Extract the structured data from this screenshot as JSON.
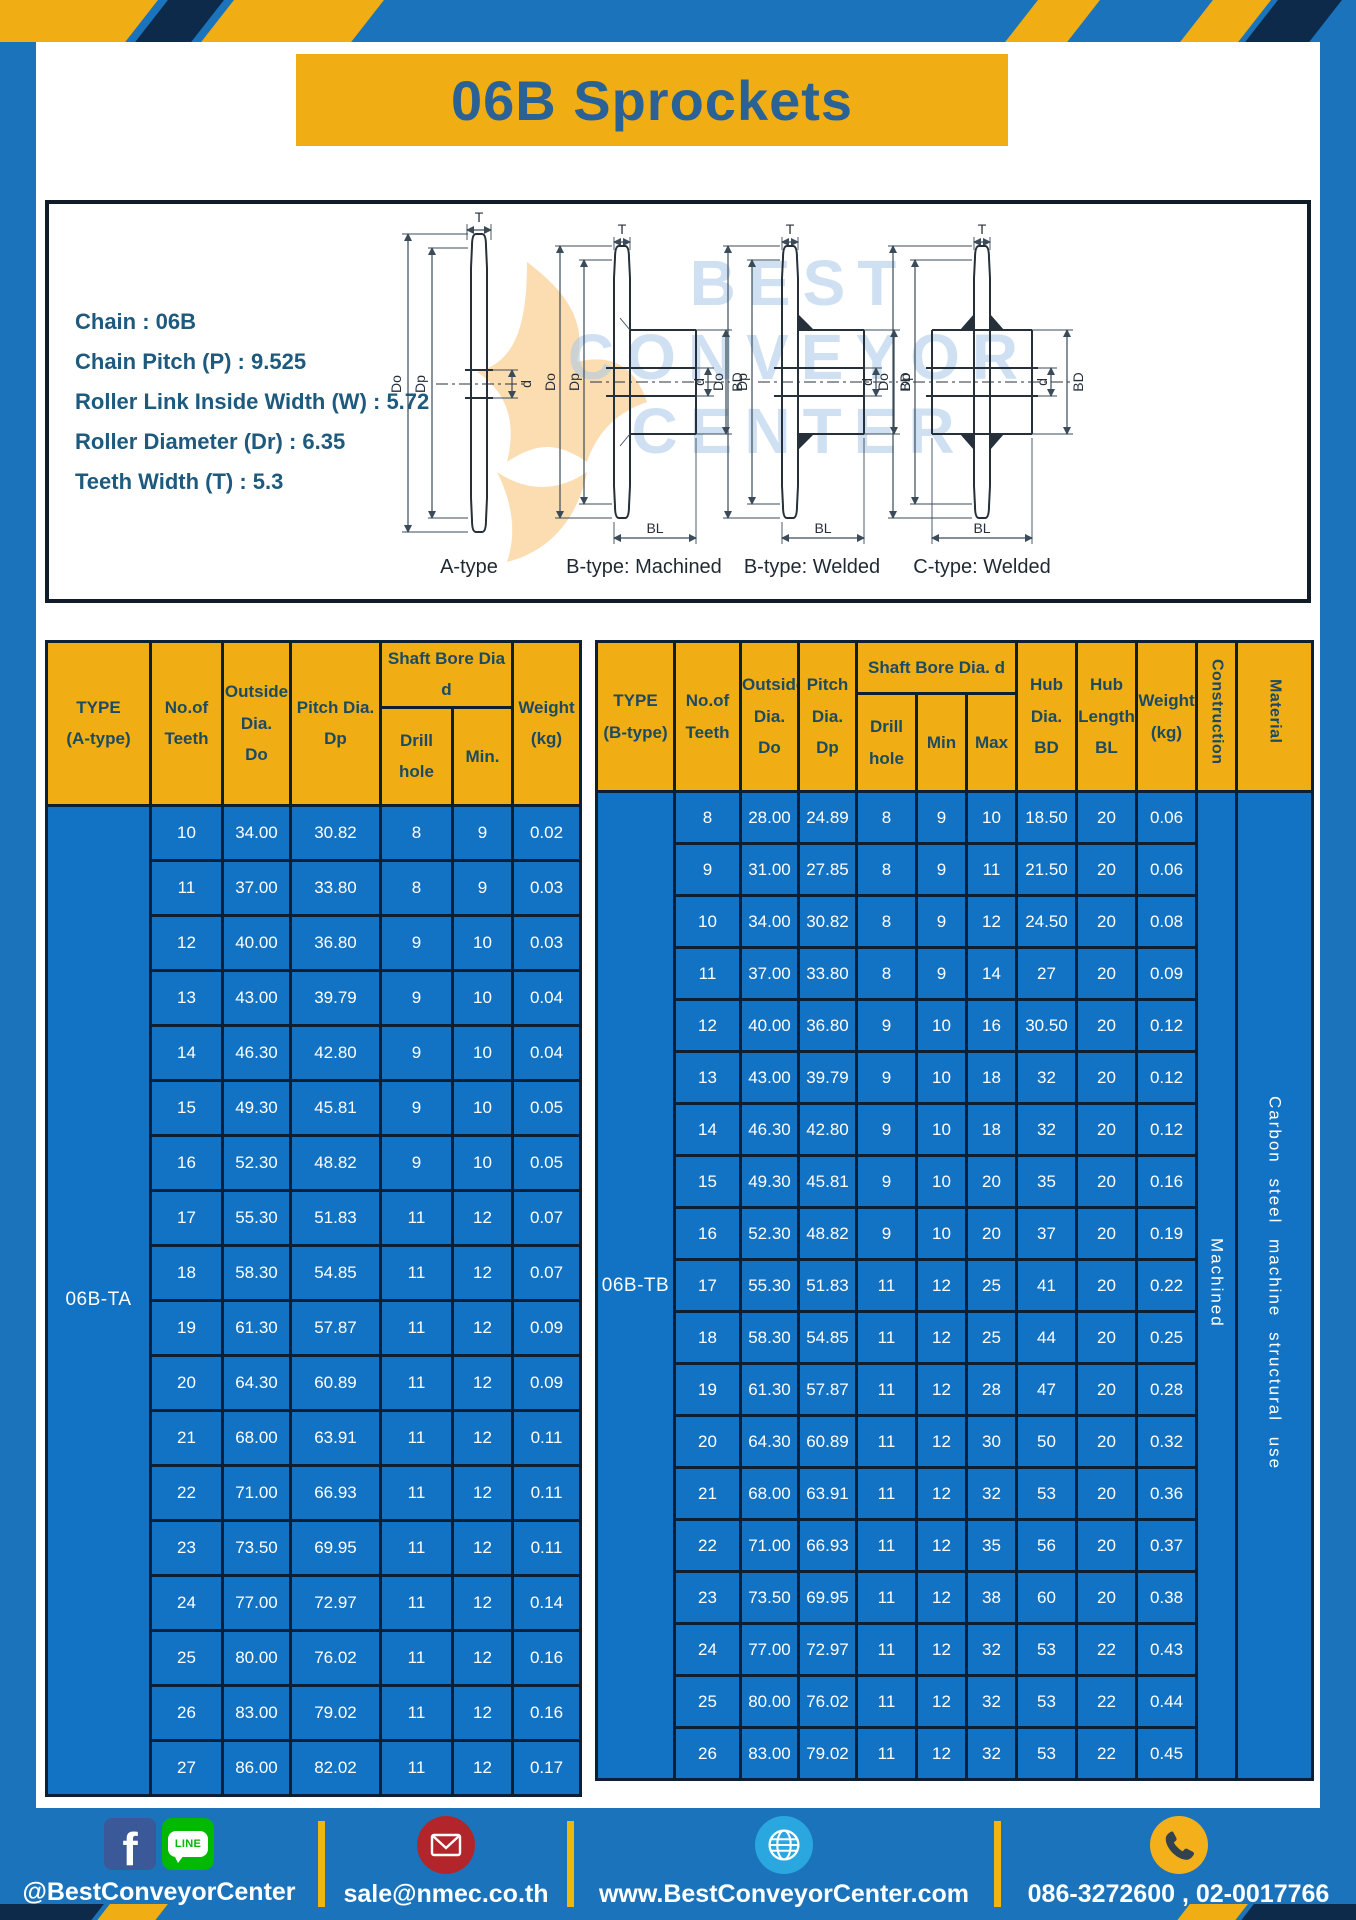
{
  "title": "06B Sprockets",
  "colors": {
    "page_blue": "#1B74BB",
    "cell_blue": "#1272C4",
    "header_yellow": "#F0AD14",
    "grid_dark": "#0D1F33",
    "title_blue": "#2B6295",
    "spec_teal": "#1D5A7E",
    "header_text": "#1C4B61",
    "stripe_navy": "#0D2A4A",
    "footer_divider": "#EFB70D"
  },
  "specs": {
    "chain": "Chain : 06B",
    "pitch": "Chain Pitch (P) : 9.525",
    "roller_width": "Roller Link Inside Width (W) : 5.72",
    "roller_dia": "Roller Diameter (Dr) : 6.35",
    "teeth_width": "Teeth Width (T) : 5.3"
  },
  "watermark": {
    "line1": "BEST",
    "line2": "CONVEYOR",
    "line3": "CENTER"
  },
  "drawings": {
    "labels": {
      "a": "A-type",
      "b_machined": "B-type: Machined",
      "b_welded": "B-type: Welded",
      "c_welded": "C-type: Welded"
    },
    "dims": {
      "t": "T",
      "do": "Do",
      "dp": "Dp",
      "d": "d",
      "bd": "BD",
      "bl": "BL"
    }
  },
  "table_a": {
    "type_label": "06B-TA",
    "header": {
      "type": "TYPE\n(A-type)",
      "teeth": "No.of\nTeeth",
      "outside": "Outside\nDia.\nDo",
      "pitch": "Pitch Dia.\nDp",
      "bore": "Shaft Bore Dia d",
      "drill": "Drill hole",
      "min": "Min.",
      "weight": "Weight\n(kg)"
    },
    "rows": [
      [
        "10",
        "34.00",
        "30.82",
        "8",
        "9",
        "0.02"
      ],
      [
        "11",
        "37.00",
        "33.80",
        "8",
        "9",
        "0.03"
      ],
      [
        "12",
        "40.00",
        "36.80",
        "9",
        "10",
        "0.03"
      ],
      [
        "13",
        "43.00",
        "39.79",
        "9",
        "10",
        "0.04"
      ],
      [
        "14",
        "46.30",
        "42.80",
        "9",
        "10",
        "0.04"
      ],
      [
        "15",
        "49.30",
        "45.81",
        "9",
        "10",
        "0.05"
      ],
      [
        "16",
        "52.30",
        "48.82",
        "9",
        "10",
        "0.05"
      ],
      [
        "17",
        "55.30",
        "51.83",
        "11",
        "12",
        "0.07"
      ],
      [
        "18",
        "58.30",
        "54.85",
        "11",
        "12",
        "0.07"
      ],
      [
        "19",
        "61.30",
        "57.87",
        "11",
        "12",
        "0.09"
      ],
      [
        "20",
        "64.30",
        "60.89",
        "11",
        "12",
        "0.09"
      ],
      [
        "21",
        "68.00",
        "63.91",
        "11",
        "12",
        "0.11"
      ],
      [
        "22",
        "71.00",
        "66.93",
        "11",
        "12",
        "0.11"
      ],
      [
        "23",
        "73.50",
        "69.95",
        "11",
        "12",
        "0.11"
      ],
      [
        "24",
        "77.00",
        "72.97",
        "11",
        "12",
        "0.14"
      ],
      [
        "25",
        "80.00",
        "76.02",
        "11",
        "12",
        "0.16"
      ],
      [
        "26",
        "83.00",
        "79.02",
        "11",
        "12",
        "0.16"
      ],
      [
        "27",
        "86.00",
        "82.02",
        "11",
        "12",
        "0.17"
      ]
    ]
  },
  "table_b": {
    "type_label": "06B-TB",
    "construction": "Machined",
    "material": "Carbon steel machine structural use",
    "header": {
      "type": "TYPE\n(B-type)",
      "teeth": "No.of\nTeeth",
      "outside": "Outside\nDia.\nDo",
      "pitch": "Pitch\nDia.\nDp",
      "bore": "Shaft Bore Dia. d",
      "drill": "Drill hole",
      "min": "Min",
      "max": "Max",
      "hub_dia": "Hub\nDia.\nBD",
      "hub_len": "Hub\nLength\nBL",
      "weight": "Weight\n(kg)",
      "construction": "Construction",
      "material": "Material"
    },
    "rows": [
      [
        "8",
        "28.00",
        "24.89",
        "8",
        "9",
        "10",
        "18.50",
        "20",
        "0.06"
      ],
      [
        "9",
        "31.00",
        "27.85",
        "8",
        "9",
        "11",
        "21.50",
        "20",
        "0.06"
      ],
      [
        "10",
        "34.00",
        "30.82",
        "8",
        "9",
        "12",
        "24.50",
        "20",
        "0.08"
      ],
      [
        "11",
        "37.00",
        "33.80",
        "8",
        "9",
        "14",
        "27",
        "20",
        "0.09"
      ],
      [
        "12",
        "40.00",
        "36.80",
        "9",
        "10",
        "16",
        "30.50",
        "20",
        "0.12"
      ],
      [
        "13",
        "43.00",
        "39.79",
        "9",
        "10",
        "18",
        "32",
        "20",
        "0.12"
      ],
      [
        "14",
        "46.30",
        "42.80",
        "9",
        "10",
        "18",
        "32",
        "20",
        "0.12"
      ],
      [
        "15",
        "49.30",
        "45.81",
        "9",
        "10",
        "20",
        "35",
        "20",
        "0.16"
      ],
      [
        "16",
        "52.30",
        "48.82",
        "9",
        "10",
        "20",
        "37",
        "20",
        "0.19"
      ],
      [
        "17",
        "55.30",
        "51.83",
        "11",
        "12",
        "25",
        "41",
        "20",
        "0.22"
      ],
      [
        "18",
        "58.30",
        "54.85",
        "11",
        "12",
        "25",
        "44",
        "20",
        "0.25"
      ],
      [
        "19",
        "61.30",
        "57.87",
        "11",
        "12",
        "28",
        "47",
        "20",
        "0.28"
      ],
      [
        "20",
        "64.30",
        "60.89",
        "11",
        "12",
        "30",
        "50",
        "20",
        "0.32"
      ],
      [
        "21",
        "68.00",
        "63.91",
        "11",
        "12",
        "32",
        "53",
        "20",
        "0.36"
      ],
      [
        "22",
        "71.00",
        "66.93",
        "11",
        "12",
        "35",
        "56",
        "20",
        "0.37"
      ],
      [
        "23",
        "73.50",
        "69.95",
        "11",
        "12",
        "38",
        "60",
        "20",
        "0.38"
      ],
      [
        "24",
        "77.00",
        "72.97",
        "11",
        "12",
        "32",
        "53",
        "22",
        "0.43"
      ],
      [
        "25",
        "80.00",
        "76.02",
        "11",
        "12",
        "32",
        "53",
        "22",
        "0.44"
      ],
      [
        "26",
        "83.00",
        "79.02",
        "11",
        "12",
        "32",
        "53",
        "22",
        "0.45"
      ]
    ]
  },
  "footer": {
    "social_label": "@BestConveyorCenter",
    "facebook_letter": "f",
    "line_text": "LINE",
    "email": "sale@nmec.co.th",
    "website": "www.BestConveyorCenter.com",
    "phone": "086-3272600 , 02-0017766"
  }
}
